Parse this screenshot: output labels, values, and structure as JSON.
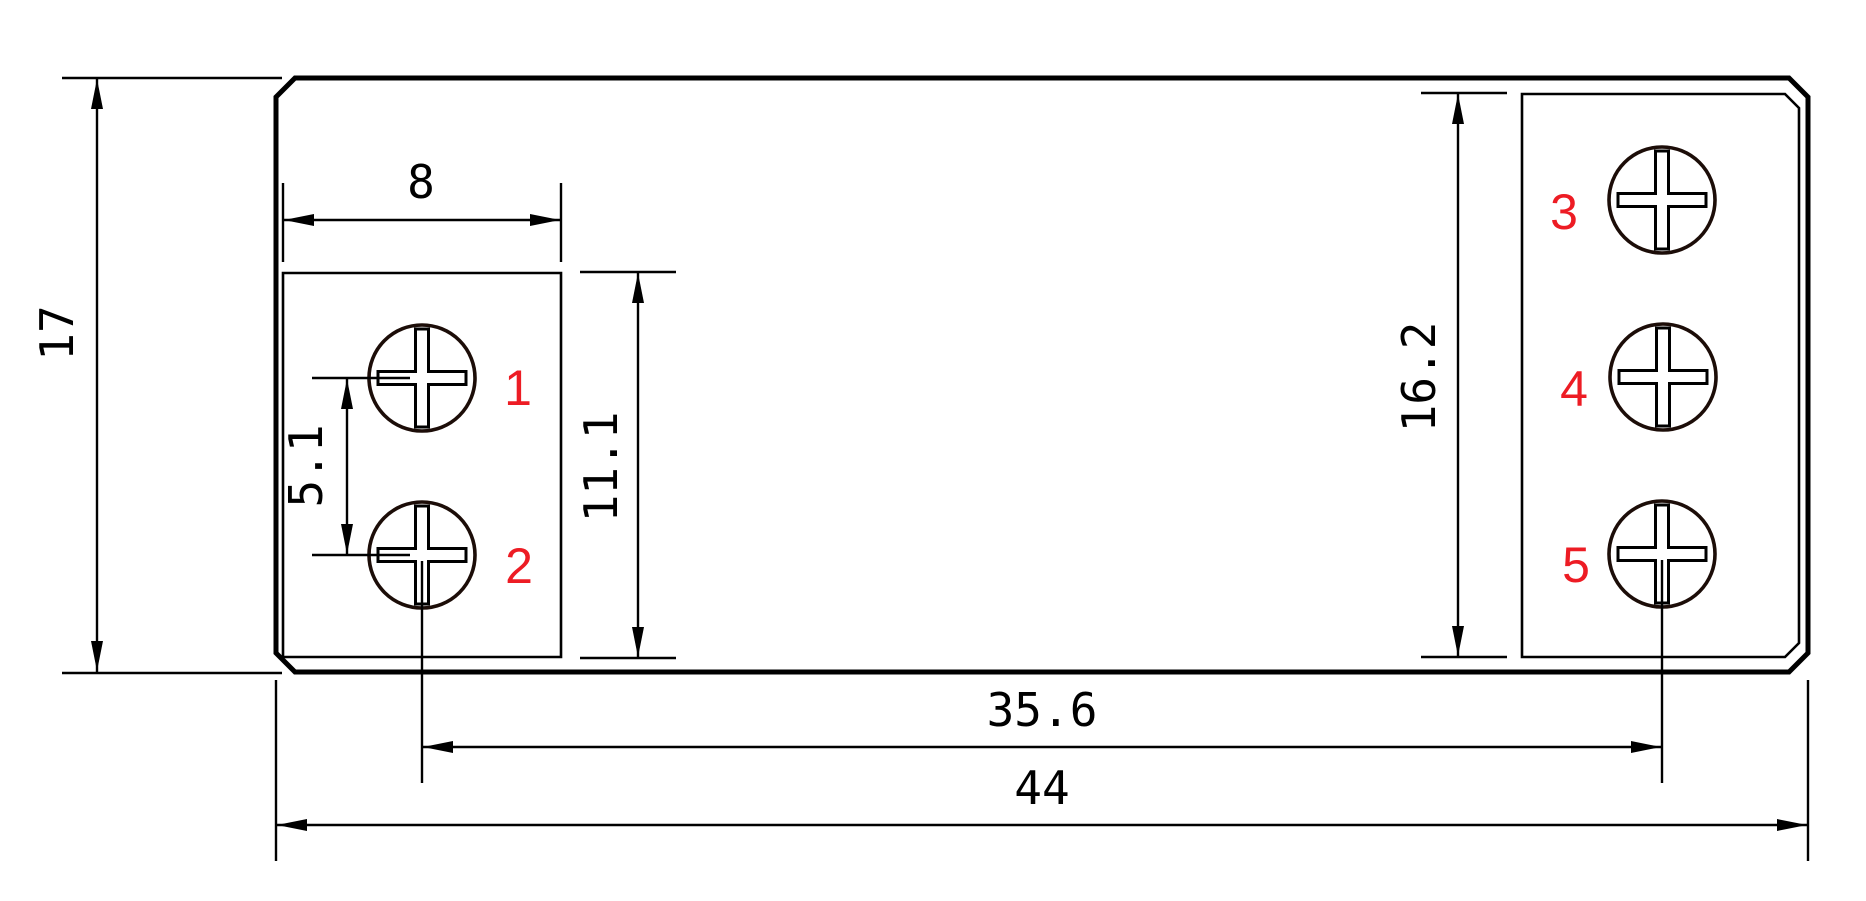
{
  "dimensions": {
    "height_overall": "17",
    "width_left_block": "8",
    "pitch_left": "5.1",
    "height_left_block": "11.1",
    "height_right_block": "16.2",
    "span_terminals": "35.6",
    "width_overall": "44"
  },
  "labels": {
    "terminals": [
      "1",
      "2",
      "3",
      "4",
      "5"
    ]
  },
  "colors": {
    "line": "#000000",
    "terminal_label": "#ed1c24",
    "background": "#ffffff"
  }
}
